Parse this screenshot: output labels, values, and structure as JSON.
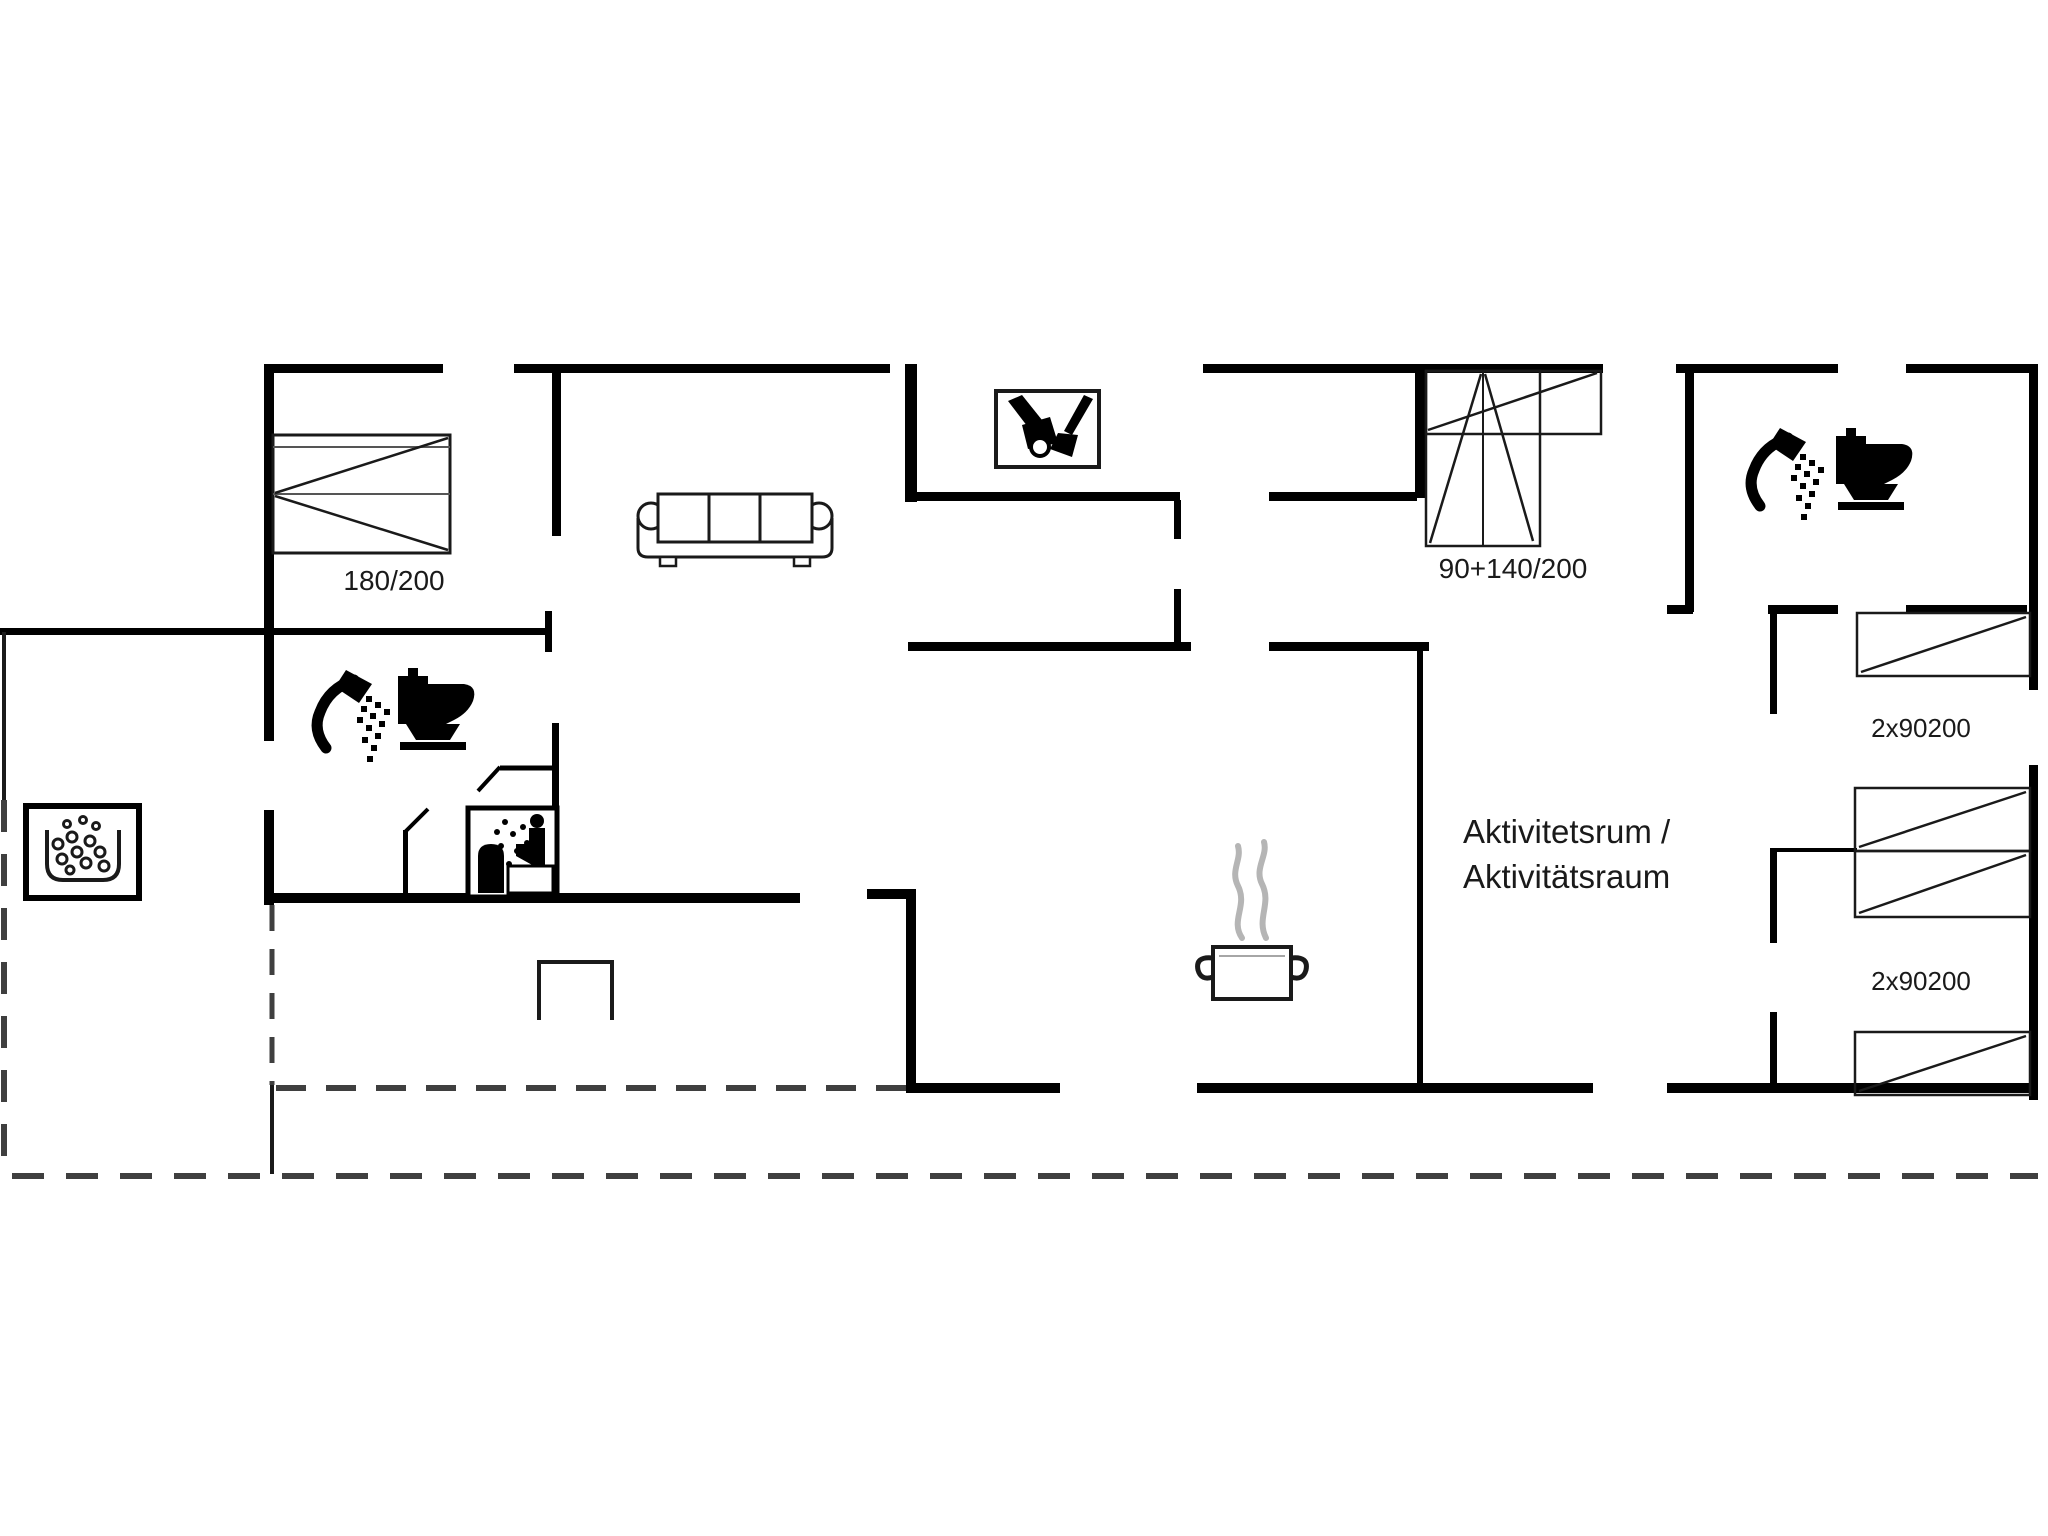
{
  "floorplan": {
    "type": "holiday-house floor plan",
    "background": "#ffffff",
    "wall_color": "#000000",
    "line_color": "#1a1a1a",
    "steam_color": "#b5b5b5",
    "dash_color": "#3f3f3f",
    "labels": {
      "bedroom1_bed_size": "180/200",
      "combo_bed_size": "90+140/200",
      "bunk_top_size": "2x90200",
      "bunk_bottom_size": "2x90200",
      "activity_room_line1": "Aktivitetsrum /",
      "activity_room_line2": "Aktivitätsraum"
    },
    "icons": [
      "double-bed-icon",
      "sofa-icon",
      "cleaning-cupboard-icon",
      "combo-bed-icon",
      "shower-icon",
      "toilet-icon",
      "whirlpool-icon",
      "sauna-icon",
      "cooking-pot-icon",
      "hearth-icon",
      "single-bed-icon"
    ]
  }
}
